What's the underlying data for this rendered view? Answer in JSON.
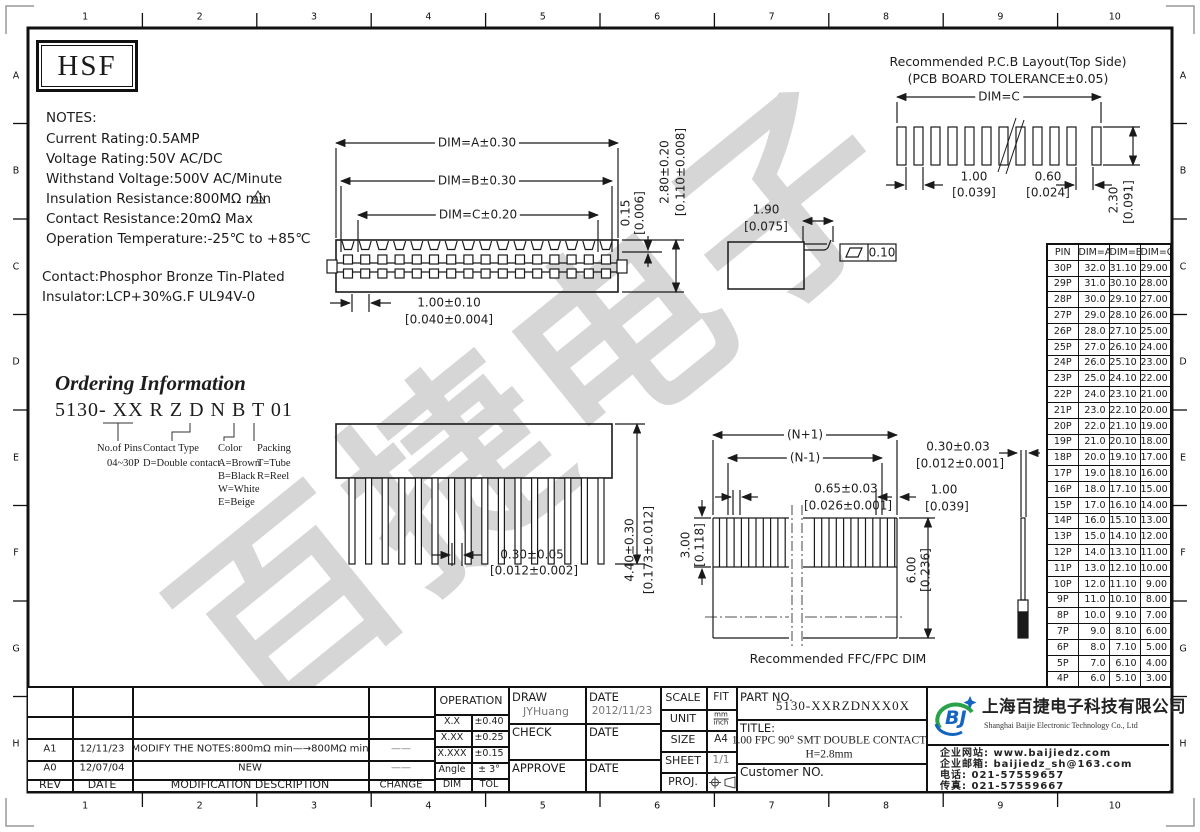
{
  "frame": {
    "cols": [
      "1",
      "2",
      "3",
      "4",
      "5",
      "6",
      "7",
      "8",
      "9",
      "10"
    ],
    "rows": [
      "A",
      "B",
      "C",
      "D",
      "E",
      "F",
      "G",
      "H"
    ]
  },
  "logo_text": "HSF",
  "notes": {
    "title": "NOTES:",
    "lines": [
      "Current Rating:0.5AMP",
      "Voltage Rating:50V AC/DC",
      "Withstand Voltage:500V AC/Minute",
      "Insulation Resistance:800MΩ min",
      "Contact Resistance:20mΩ Max",
      "Operation Temperature:-25℃ to +85℃"
    ],
    "rev_marker": "A1",
    "material": [
      "Contact:Phosphor Bronze Tin-Plated",
      "Insulator:LCP+30%G.F UL94V-0"
    ]
  },
  "ordering": {
    "title": "Ordering Information",
    "code": "5130- XX  R Z D N  B T 01",
    "pins_label": "No.of Pins",
    "pins_value": "04~30P",
    "contact_label": "Contact Type",
    "contact_value": "D=Double contact",
    "color_label": "Color",
    "color_values": [
      "A=Brown",
      "B=Black",
      "W=White",
      "E=Beige"
    ],
    "packing_label": "Packing",
    "packing_values": [
      "T=Tube",
      "R=Reel"
    ]
  },
  "top_view": {
    "dim_a": "DIM=A±0.30",
    "dim_b": "DIM=B±0.30",
    "dim_c": "DIM=C±0.20",
    "pitch": "1.00±0.10",
    "pitch_in": "[0.040±0.004]",
    "step": "0.15",
    "step_in": "[0.006]",
    "height": "2.80±0.20",
    "height_in": "[0.110±0.008]"
  },
  "side_detail": {
    "d": "1.90",
    "d_in": "[0.075]",
    "flatness": "0.10"
  },
  "pcb": {
    "title1": "Recommended P.C.B Layout(Top Side)",
    "title2": "(PCB BOARD TOLERANCE±0.05)",
    "dim_c": "DIM=C",
    "pitch": "1.00",
    "pitch_in": "[0.039]",
    "width": "0.60",
    "width_in": "[0.024]",
    "height": "2.30",
    "height_in": "[0.091]"
  },
  "front_view": {
    "pin_w": "0.30±0.05",
    "pin_w_in": "[0.012±0.002]",
    "height": "4.40±0.30",
    "height_in": "[0.173±0.012]"
  },
  "ffc": {
    "np1": "(N+1)",
    "nm1": "(N-1)",
    "pitch": "0.65±0.03",
    "pitch_in": "[0.026±0.001]",
    "thick": "0.30±0.03",
    "thick_in": "[0.012±0.001]",
    "margin": "1.00",
    "margin_in": "[0.039]",
    "exp": "3.00",
    "exp_in": "[0.118]",
    "stiff": "6.00",
    "stiff_in": "[0.236]",
    "caption": "Recommended FFC/FPC DIM"
  },
  "pin_table": {
    "headers": [
      "PIN",
      "DIM=A",
      "DIM=B",
      "DIM=C"
    ],
    "rows": [
      [
        "30P",
        "32.0",
        "31.10",
        "29.00"
      ],
      [
        "29P",
        "31.0",
        "30.10",
        "28.00"
      ],
      [
        "28P",
        "30.0",
        "29.10",
        "27.00"
      ],
      [
        "27P",
        "29.0",
        "28.10",
        "26.00"
      ],
      [
        "26P",
        "28.0",
        "27.10",
        "25.00"
      ],
      [
        "25P",
        "27.0",
        "26.10",
        "24.00"
      ],
      [
        "24P",
        "26.0",
        "25.10",
        "23.00"
      ],
      [
        "23P",
        "25.0",
        "24.10",
        "22.00"
      ],
      [
        "22P",
        "24.0",
        "23.10",
        "21.00"
      ],
      [
        "21P",
        "23.0",
        "22.10",
        "20.00"
      ],
      [
        "20P",
        "22.0",
        "21.10",
        "19.00"
      ],
      [
        "19P",
        "21.0",
        "20.10",
        "18.00"
      ],
      [
        "18P",
        "20.0",
        "19.10",
        "17.00"
      ],
      [
        "17P",
        "19.0",
        "18.10",
        "16.00"
      ],
      [
        "16P",
        "18.0",
        "17.10",
        "15.00"
      ],
      [
        "15P",
        "17.0",
        "16.10",
        "14.00"
      ],
      [
        "14P",
        "16.0",
        "15.10",
        "13.00"
      ],
      [
        "13P",
        "15.0",
        "14.10",
        "12.00"
      ],
      [
        "12P",
        "14.0",
        "13.10",
        "11.00"
      ],
      [
        "11P",
        "13.0",
        "12.10",
        "10.00"
      ],
      [
        "10P",
        "12.0",
        "11.10",
        "9.00"
      ],
      [
        "9P",
        "11.0",
        "10.10",
        "8.00"
      ],
      [
        "8P",
        "10.0",
        "9.10",
        "7.00"
      ],
      [
        "7P",
        "9.0",
        "8.10",
        "6.00"
      ],
      [
        "6P",
        "8.0",
        "7.10",
        "5.00"
      ],
      [
        "5P",
        "7.0",
        "6.10",
        "4.00"
      ],
      [
        "4P",
        "6.0",
        "5.10",
        "3.00"
      ]
    ]
  },
  "revision": {
    "headers": [
      "REV",
      "DATE",
      "MODIFICATION DESCRIPTION",
      "CHANGE"
    ],
    "rows": [
      [
        "A1",
        "12/11/23",
        "MODIFY THE NOTES:800mΩ min—→800MΩ min",
        "——"
      ],
      [
        "A0",
        "12/07/04",
        "NEW",
        "——"
      ]
    ]
  },
  "operation": {
    "title": "OPERATION",
    "rows": [
      [
        "X.X",
        "±0.40"
      ],
      [
        "X.XX",
        "±0.25"
      ],
      [
        "X.XXX",
        "±0.15"
      ],
      [
        "Angle",
        "± 3°"
      ],
      [
        "DIM",
        "TOL"
      ]
    ]
  },
  "sign": {
    "draw_label": "DRAW",
    "draw_name": "JYHuang",
    "date_label": "DATE",
    "draw_date": "2012/11/23",
    "check_label": "CHECK",
    "approve_label": "APPROVE"
  },
  "info": {
    "scale_label": "SCALE",
    "scale": "FIT",
    "unit_label": "UNIT",
    "unit_top": "mm",
    "unit_bottom": "inch",
    "size_label": "SIZE",
    "size": "A4",
    "sheet_label": "SHEET",
    "sheet": "1/1",
    "proj_label": "PROJ."
  },
  "part": {
    "label": "PART NO.",
    "number": "5130-XXRZDNXX0X",
    "title_label": "TITLE:",
    "title1": "1.00 FPC 90° SMT DOUBLE CONTACT",
    "title2": "H=2.8mm",
    "customer": "Customer NO."
  },
  "company": {
    "logo": "BJ",
    "name_cn": "上海百捷电子科技有限公司",
    "name_en": "Shanghai Baijie Electronic Technology Co., Ltd",
    "website": "企业网站: www.baijiedz.com",
    "email": "企业邮箱: baijiedz_sh@163.com",
    "tel": "电话: 021-57559657",
    "fax": "传真: 021-57559667"
  },
  "watermark": "百捷电子",
  "colors": {
    "line": "#1a1a1a",
    "watermark": "#d6d6d6",
    "logo_green": "#2aa24a",
    "logo_blue": "#1565c0",
    "gray": "#777777"
  }
}
